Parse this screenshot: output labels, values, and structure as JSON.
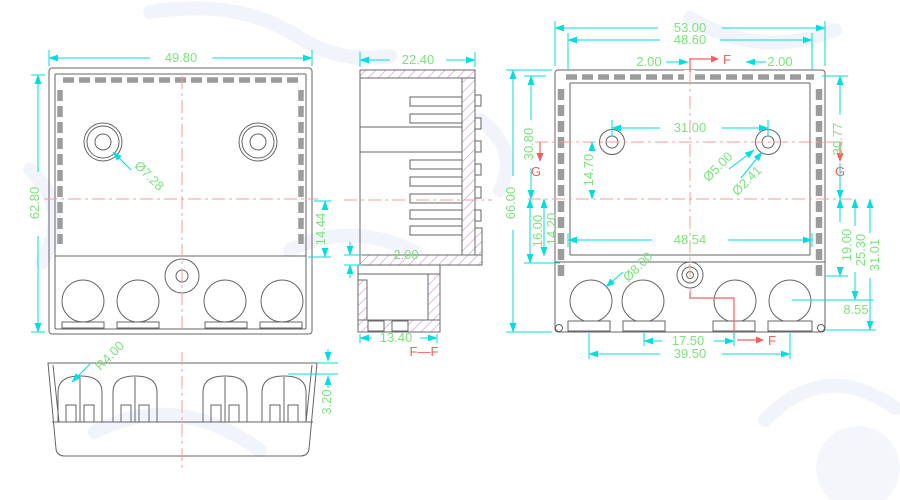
{
  "title": "enclosure-cad-drawing",
  "views": {
    "front": {
      "dims": {
        "width": "49.80",
        "height": "62.80",
        "hole_dia": "Ø7.28",
        "band_height": "14.44"
      }
    },
    "bottom": {
      "dims": {
        "radius": "R4.00",
        "lip": "3.20"
      }
    },
    "section": {
      "dims": {
        "depth": "22.40",
        "wall": "2.00",
        "base": "13.40"
      },
      "label": "F—F"
    },
    "back": {
      "dims": {
        "overall_width": "53.00",
        "inner_width": "48.60",
        "edge_left": "2.00",
        "edge_right": "2.00",
        "hole_spacing": "31.00",
        "hole_offset": "14.70",
        "boss_dia": "Ø5.00",
        "hole_dia": "Ø2.41",
        "height_left": "30.80",
        "height_right": "30.77",
        "overall_height": "66.00",
        "cavity_16": "16.00",
        "cavity_14": "14.20",
        "inner_width_bottom": "48.54",
        "knockout_dia": "Ø8.00",
        "d19": "19.00",
        "d25": "25.30",
        "d31": "31.01",
        "slot_edge": "8.55",
        "slot_pitch": "17.50",
        "slot_span": "39.50"
      },
      "markers": {
        "f": "F",
        "g": "G"
      }
    }
  },
  "colors": {
    "outline": "#646464",
    "dimension_line": "#00dede",
    "dimension_text": "#7de27d",
    "centerline": "#f79c9c",
    "section_label": "#f25f5f",
    "hatch": "#d494dc"
  }
}
